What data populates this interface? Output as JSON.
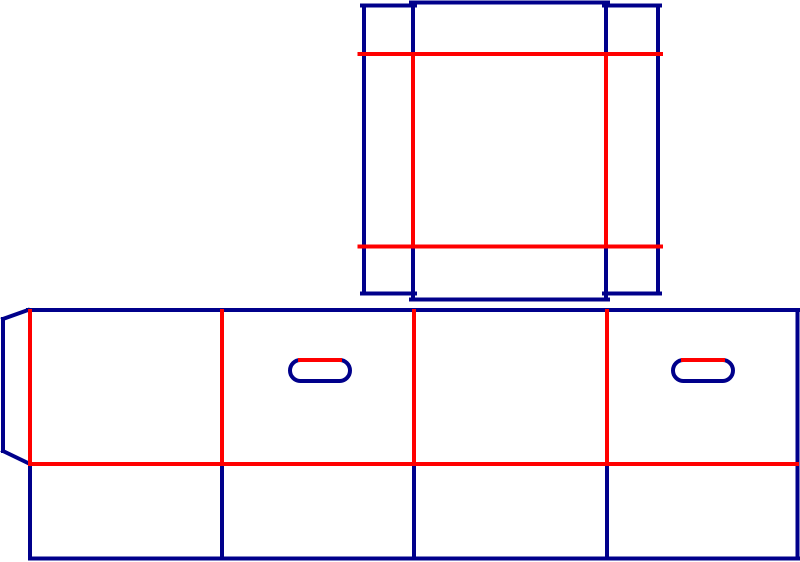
{
  "document": {
    "kind": "packaging-dieline",
    "description": "Die-cut template drawing of a folding carton: a square tray lid piece on top and a four-panel body strip with glue flap, bottom flaps and two handle cutouts below"
  },
  "canvas": {
    "width": 800,
    "height": 562,
    "background": "#FFFFFF"
  },
  "legend": {
    "cut_color": "#00008B",
    "crease_color": "#FF0000",
    "cut_meaning": "cut line",
    "crease_meaning": "crease / fold line"
  },
  "stroke_width": 4,
  "lid": {
    "segments": [
      {
        "name": "lid-top-edge-center",
        "type": "cut",
        "x1": 411,
        "y1": 2.5,
        "x2": 608,
        "y2": 2.5
      },
      {
        "name": "lid-top-left-tab-top",
        "type": "cut",
        "x1": 362,
        "y1": 5.5,
        "x2": 415,
        "y2": 5.5
      },
      {
        "name": "lid-top-right-tab-top",
        "type": "cut",
        "x1": 604,
        "y1": 5.5,
        "x2": 660,
        "y2": 5.5
      },
      {
        "name": "lid-left-outer-edge",
        "type": "cut",
        "x1": 364,
        "y1": 5.5,
        "x2": 364,
        "y2": 293.5
      },
      {
        "name": "lid-right-outer-edge",
        "type": "cut",
        "x1": 658,
        "y1": 5.5,
        "x2": 658,
        "y2": 293.5
      },
      {
        "name": "lid-left-inner-edge-upper",
        "type": "cut",
        "x1": 413,
        "y1": 2.5,
        "x2": 413,
        "y2": 54
      },
      {
        "name": "lid-right-inner-edge-upper",
        "type": "cut",
        "x1": 606,
        "y1": 2.5,
        "x2": 606,
        "y2": 54
      },
      {
        "name": "lid-left-inner-edge-lower",
        "type": "cut",
        "x1": 413,
        "y1": 246.5,
        "x2": 413,
        "y2": 299.5
      },
      {
        "name": "lid-right-inner-edge-lower",
        "type": "cut",
        "x1": 606,
        "y1": 246.5,
        "x2": 606,
        "y2": 299.5
      },
      {
        "name": "lid-bottom-left-tab-bottom",
        "type": "cut",
        "x1": 362,
        "y1": 293.5,
        "x2": 415,
        "y2": 293.5
      },
      {
        "name": "lid-bottom-right-tab-bottom",
        "type": "cut",
        "x1": 604,
        "y1": 293.5,
        "x2": 660,
        "y2": 293.5
      },
      {
        "name": "lid-bottom-edge-center",
        "type": "cut",
        "x1": 411,
        "y1": 299.5,
        "x2": 608,
        "y2": 299.5
      },
      {
        "name": "lid-crease-top",
        "type": "crease",
        "x1": 359.5,
        "y1": 54,
        "x2": 661,
        "y2": 54
      },
      {
        "name": "lid-crease-bottom",
        "type": "crease",
        "x1": 359.5,
        "y1": 246.5,
        "x2": 661,
        "y2": 246.5
      },
      {
        "name": "lid-crease-left",
        "type": "crease",
        "x1": 413,
        "y1": 54,
        "x2": 413,
        "y2": 246.5
      },
      {
        "name": "lid-crease-right",
        "type": "crease",
        "x1": 606,
        "y1": 54,
        "x2": 606,
        "y2": 246.5
      }
    ]
  },
  "body": {
    "segments": [
      {
        "name": "body-top-edge",
        "type": "cut",
        "x1": 28,
        "y1": 310,
        "x2": 799,
        "y2": 310
      },
      {
        "name": "body-right-edge",
        "type": "cut",
        "x1": 797.5,
        "y1": 310,
        "x2": 797.5,
        "y2": 558.5
      },
      {
        "name": "body-bottom-edge",
        "type": "cut",
        "x1": 30,
        "y1": 558.5,
        "x2": 798,
        "y2": 558.5
      },
      {
        "name": "glue-flap-top-diagonal",
        "type": "cut",
        "x1": 28,
        "y1": 310,
        "x2": 3,
        "y2": 319
      },
      {
        "name": "glue-flap-left-edge",
        "type": "cut",
        "x1": 3,
        "y1": 319,
        "x2": 3,
        "y2": 451
      },
      {
        "name": "glue-flap-bottom-diagonal",
        "type": "cut",
        "x1": 3,
        "y1": 451,
        "x2": 30,
        "y2": 464
      },
      {
        "name": "bottom-flap-divider-1",
        "type": "cut",
        "x1": 30,
        "y1": 464,
        "x2": 30,
        "y2": 558.5
      },
      {
        "name": "bottom-flap-divider-2",
        "type": "cut",
        "x1": 222,
        "y1": 464,
        "x2": 222,
        "y2": 558.5
      },
      {
        "name": "bottom-flap-divider-3",
        "type": "cut",
        "x1": 414,
        "y1": 464,
        "x2": 414,
        "y2": 558.5
      },
      {
        "name": "bottom-flap-divider-4",
        "type": "cut",
        "x1": 607,
        "y1": 464,
        "x2": 607,
        "y2": 558.5
      },
      {
        "name": "panel-fold-vertical-1",
        "type": "crease",
        "x1": 30,
        "y1": 311,
        "x2": 30,
        "y2": 463
      },
      {
        "name": "panel-fold-vertical-2",
        "type": "crease",
        "x1": 222,
        "y1": 311,
        "x2": 222,
        "y2": 463
      },
      {
        "name": "panel-fold-vertical-3",
        "type": "crease",
        "x1": 414,
        "y1": 311,
        "x2": 414,
        "y2": 463
      },
      {
        "name": "panel-fold-vertical-4",
        "type": "crease",
        "x1": 607,
        "y1": 311,
        "x2": 607,
        "y2": 463
      },
      {
        "name": "body-bottom-fold",
        "type": "crease",
        "x1": 30,
        "y1": 464,
        "x2": 797,
        "y2": 464
      }
    ]
  },
  "handles": [
    {
      "name": "handle-hole-1",
      "x": 290,
      "y": 360,
      "width": 60,
      "height": 21,
      "radius": 10.5,
      "crease": {
        "name": "handle-1-fold",
        "x1": 300,
        "y1": 360,
        "x2": 340,
        "y2": 360
      }
    },
    {
      "name": "handle-hole-2",
      "x": 673,
      "y": 360,
      "width": 60,
      "height": 21,
      "radius": 10.5,
      "crease": {
        "name": "handle-2-fold",
        "x1": 683,
        "y1": 360,
        "x2": 723,
        "y2": 360
      }
    }
  ]
}
